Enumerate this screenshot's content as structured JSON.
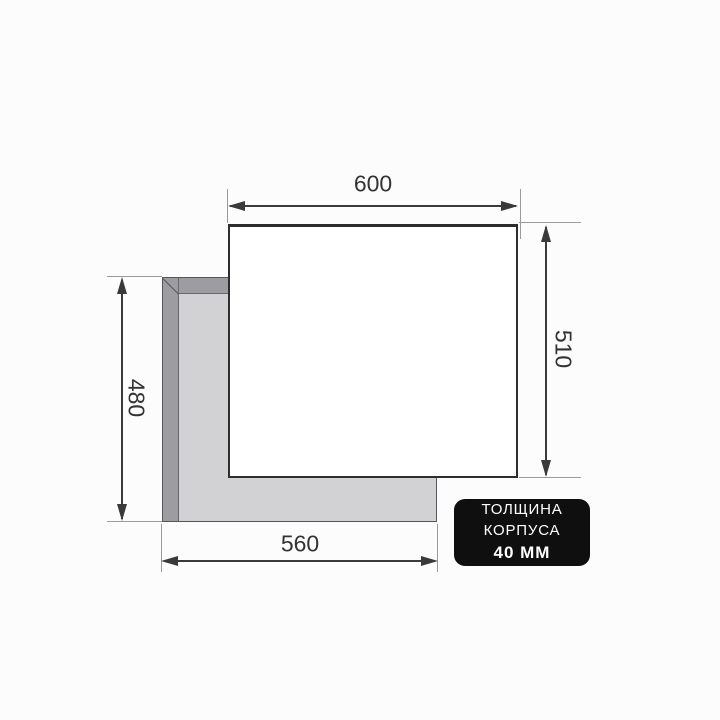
{
  "diagram": {
    "dimensions": {
      "top": "600",
      "right": "510",
      "left": "480",
      "bottom": "560"
    },
    "badge": {
      "line1": "ТОЛЩИНА",
      "line2": "КОРПУСА",
      "line3": "40 ММ"
    }
  },
  "colors": {
    "canvas-bg": "#fcfcfc",
    "dim-line": "#3a3a3a",
    "ext-line": "#9a9a9a",
    "label-text": "#333333",
    "panel-fill": "#d2d2d4",
    "panel-band": "#9d9da1",
    "panel-outline": "#55555a",
    "box-fill": "#ffffff",
    "box-border": "#2e2e2e",
    "badge-bg": "#0f0f0f",
    "badge-text": "#ffffff"
  }
}
